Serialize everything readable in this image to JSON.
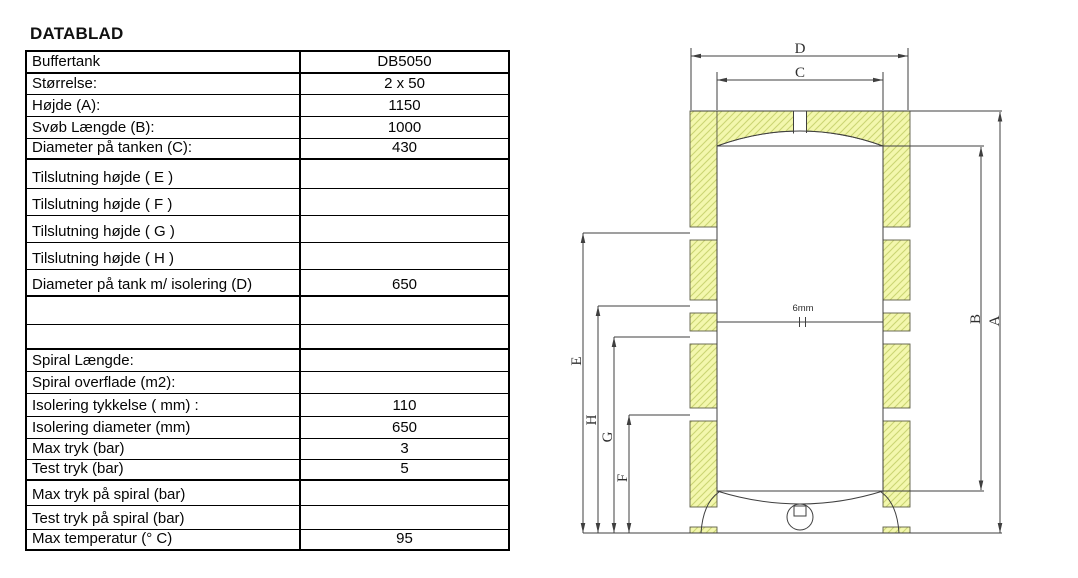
{
  "title": "DATABLAD",
  "table": {
    "rows": [
      {
        "label": "Buffertank",
        "value": "DB5050"
      },
      {
        "label": "Størrelse:",
        "value": "2 x 50"
      },
      {
        "label": "Højde (A):",
        "value": "1150"
      },
      {
        "label": "Svøb Længde (B):",
        "value": "1000"
      },
      {
        "label": "Diameter på tanken (C):",
        "value": "430"
      },
      {
        "label": "Tilslutning højde ( E )",
        "value": ""
      },
      {
        "label": "Tilslutning højde ( F )",
        "value": ""
      },
      {
        "label": "Tilslutning højde ( G )",
        "value": ""
      },
      {
        "label": "Tilslutning højde ( H )",
        "value": ""
      },
      {
        "label": "Diameter på tank m/ isolering (D)",
        "value": "650"
      },
      {
        "label": "",
        "value": ""
      },
      {
        "label": "",
        "value": ""
      },
      {
        "label": "Spiral Længde:",
        "value": ""
      },
      {
        "label": "Spiral overflade (m2):",
        "value": ""
      },
      {
        "label": "Isolering tykkelse ( mm) :",
        "value": "110"
      },
      {
        "label": "Isolering diameter (mm)",
        "value": "650"
      },
      {
        "label": "Max tryk (bar)",
        "value": "3"
      },
      {
        "label": "Test tryk (bar)",
        "value": "5"
      },
      {
        "label": "Max tryk på spiral (bar)",
        "value": ""
      },
      {
        "label": "Test tryk på spiral (bar)",
        "value": ""
      },
      {
        "label": "Max temperatur (° C)",
        "value": "95"
      }
    ]
  },
  "diagram": {
    "labels": {
      "D": "D",
      "C": "C",
      "A": "A",
      "B": "B",
      "E": "E",
      "F": "F",
      "G": "G",
      "H": "H"
    },
    "wall_thickness": "6mm",
    "colors": {
      "insulation_fill": "#f3f7ad",
      "insulation_hatch": "#cbd573",
      "line": "#3f3f3f"
    }
  }
}
